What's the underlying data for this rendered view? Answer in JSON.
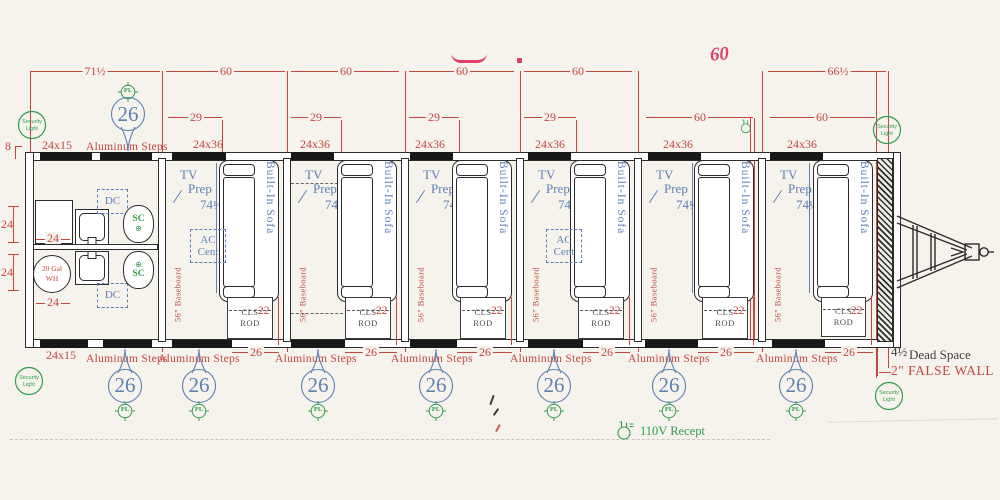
{
  "colors": {
    "paper": "#f6f3ec",
    "ink": "#2b2b2b",
    "red": "#c2473f",
    "blue": "#5d80b5",
    "green": "#2f9d4d",
    "pink": "#e0406c"
  },
  "dims": {
    "row1": [
      "71½",
      "60",
      "60",
      "60",
      "60",
      "60",
      "66½"
    ],
    "row2_29": "29",
    "row2_60": "60",
    "window": "24x36",
    "front_window": "24x15",
    "front_offset": "8",
    "bath": "24",
    "sofa_length": "74½",
    "closet": "22",
    "door": "26",
    "balloon": "26"
  },
  "labels": {
    "tv1": "TV",
    "tv2": "Prep",
    "sofa": "Built-In Sofa",
    "ac1": "AC",
    "ac2": "Cent",
    "dc": "DC",
    "sc": "SC",
    "sc_cross": "⊕",
    "cls1": "CLS",
    "cls2": "ROD",
    "baseboard": "56\" Baseboard",
    "steps": "Aluminum Steps",
    "wh1": "20 Gal",
    "wh2": "WH",
    "pl": "PL",
    "sec1": "Security",
    "sec2": "Light",
    "dead1": "4½",
    "dead2": "Dead Space",
    "false_wall": "2\" FALSE WALL",
    "recept": "110V Recept"
  }
}
